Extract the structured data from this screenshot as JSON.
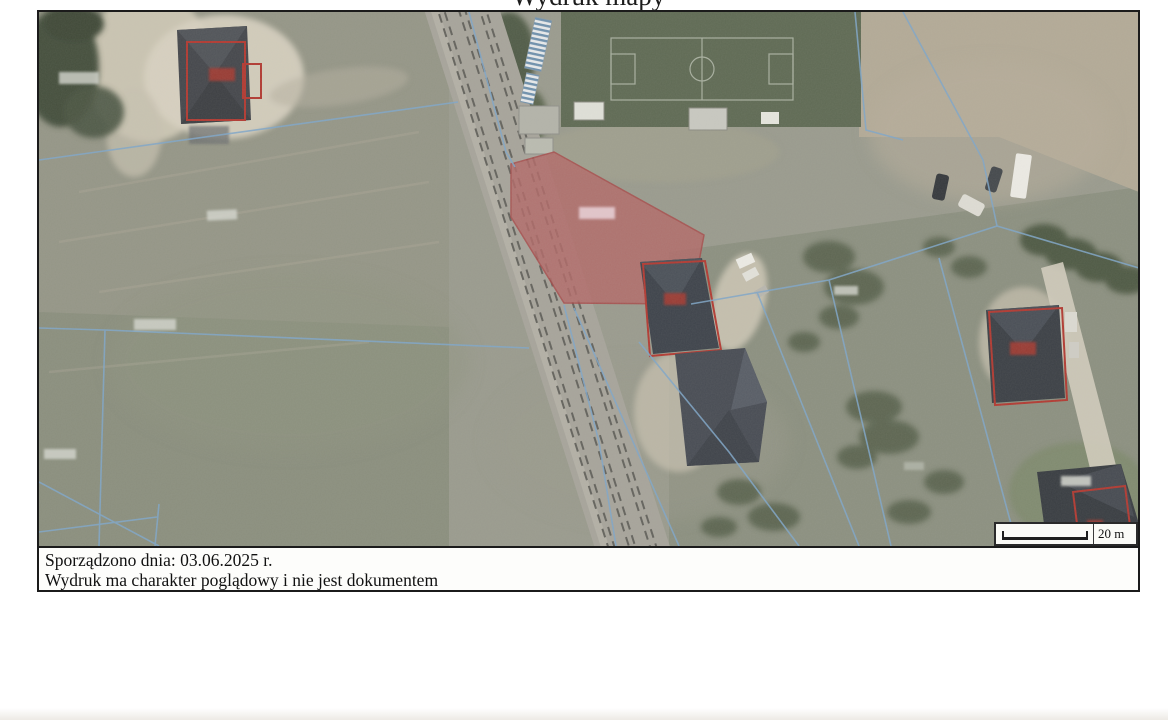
{
  "title": {
    "text": "Wydruk mapy"
  },
  "footer": {
    "line1": "Sporządzono dnia: 03.06.2025 r.",
    "line2": "Wydruk ma charakter poglądowy i nie jest dokumentem"
  },
  "scale_bar": {
    "label": "20 m"
  },
  "colors": {
    "highlighted_parcel_fill": "#b26a68",
    "building_outline_red": "#b23a32",
    "boundary_line_blue": "#7fa6c8",
    "page_border": "#1b1b1b"
  }
}
